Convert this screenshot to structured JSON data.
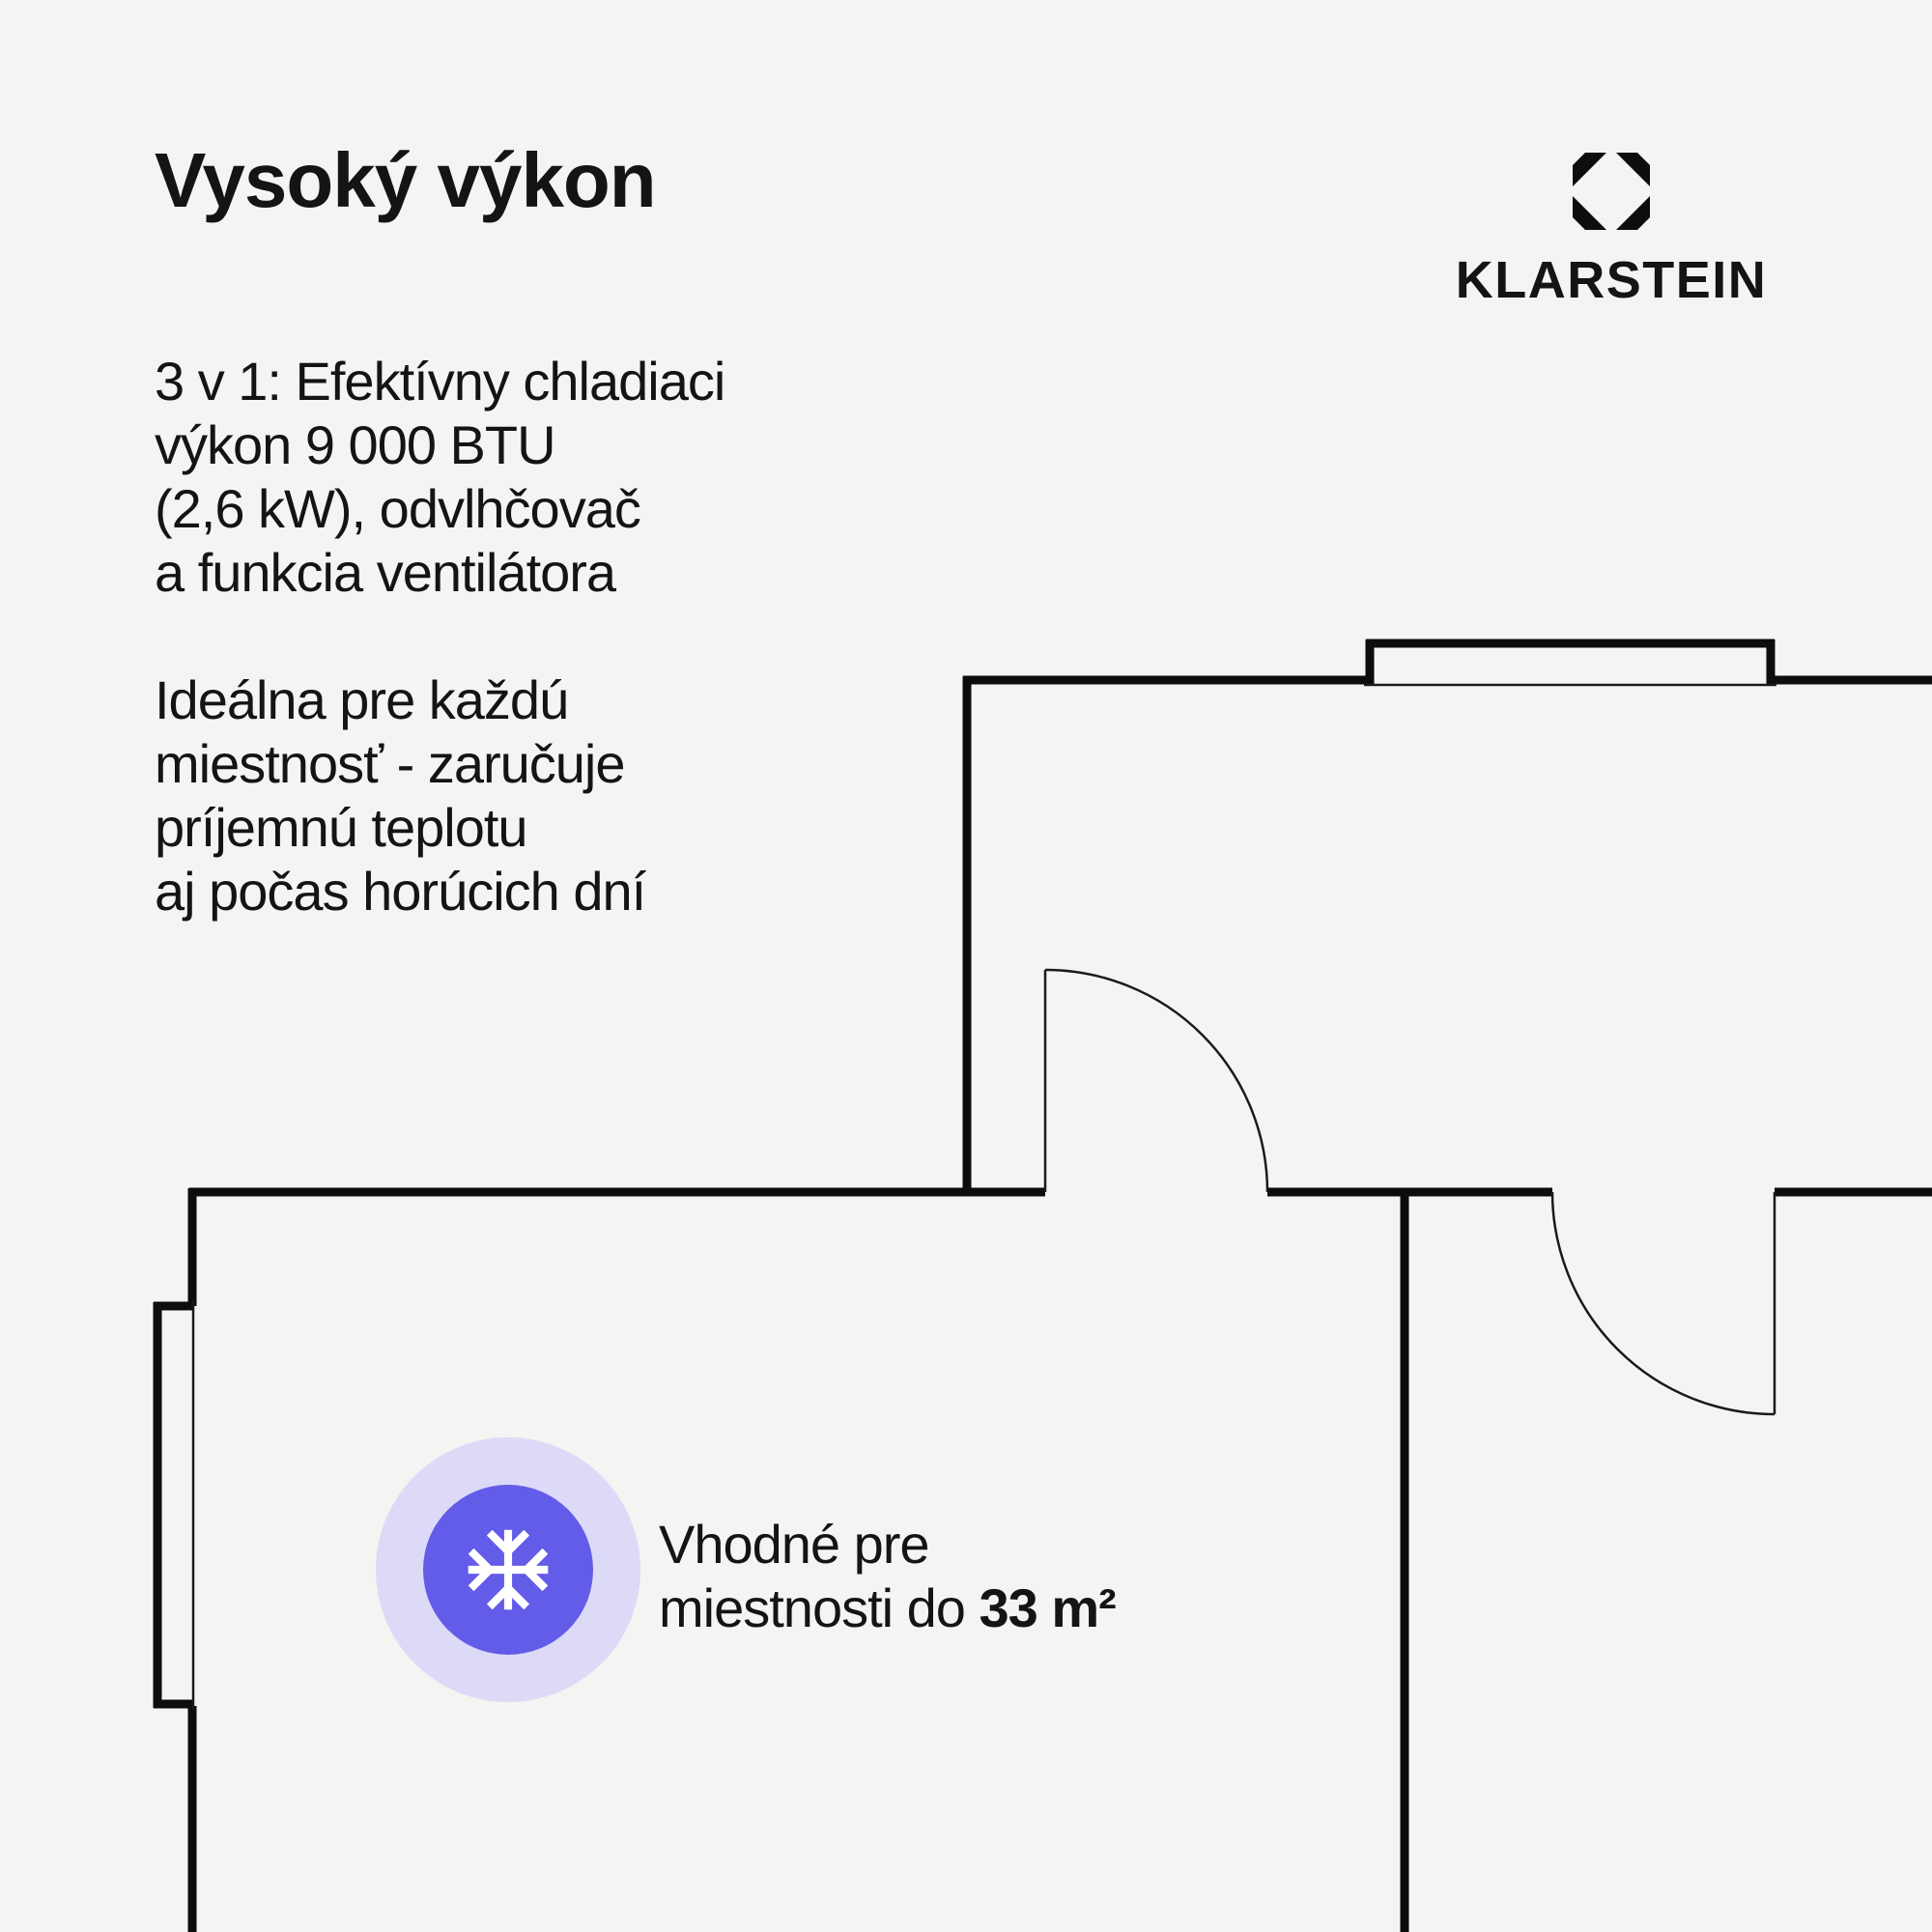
{
  "theme": {
    "background": "#f4f4f2",
    "ink": "#141414",
    "wall_color": "#0d0d0d",
    "badge_inner": "#635ce8",
    "badge_ring": "#dcdaf6",
    "snowflake": "#ffffff"
  },
  "header": {
    "title": "Vysoký výkon"
  },
  "brand": {
    "wordmark": "KLARSTEIN",
    "logo_icon": "klarstein-octagon-diamond"
  },
  "intro": {
    "lines": [
      "3 v 1: Efektívny chladiaci",
      "výkon 9 000 BTU",
      "(2,6 kW), odvlhčovač",
      "a funkcia ventilátora"
    ]
  },
  "benefit": {
    "lines": [
      "Ideálna pre každú",
      "miestnosť - zaručuje",
      "príjemnú teplotu",
      "aj počas horúcich dní"
    ]
  },
  "room_callout": {
    "icon": "snowflake-icon",
    "line1": "Vhodné pre",
    "line2_regular": "miestnosti do ",
    "line2_bold": "33 m²"
  }
}
